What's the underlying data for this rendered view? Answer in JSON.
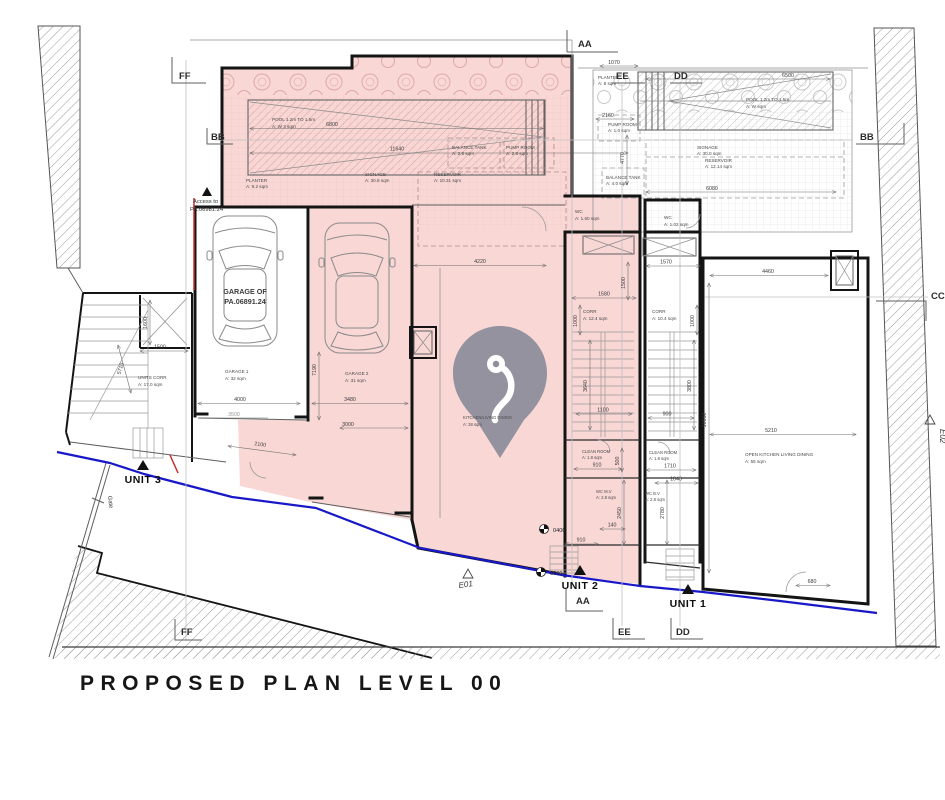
{
  "title": "PROPOSED PLAN LEVEL 00",
  "colors": {
    "highlight_pink": "#f8d7d5",
    "boundary_blue": "#1818c8",
    "boundary_red": "#cc2b2b",
    "pin_gray": "#8e8e9b"
  },
  "section_markers": {
    "aa": "AA",
    "bb": "BB",
    "cc": "CC",
    "dd": "DD",
    "ee": "EE",
    "ff": "FF"
  },
  "unit_markers": {
    "unit1": "UNIT 1",
    "unit2": "UNIT 2",
    "unit3": "UNIT 3"
  },
  "elevation_markers": {
    "e01": "E01",
    "e02": "E02"
  },
  "levels": {
    "l0400": "0400",
    "l0000": "0000"
  },
  "site": {
    "gate": "Gate",
    "access1": "Access to",
    "access2": "PA.06981.24",
    "garage_of1": "GARAGE OF",
    "garage_of2": "PA.06891.24"
  },
  "rooms": {
    "pool_l1": "POOL 1.2m TO 1.5m",
    "pool_l2": "A: W 3 sqm",
    "planter_l1": "PLANTER",
    "planter_l2": "A: 9.2 sqm",
    "signage_l1": "SIGNAGE",
    "signage_l2": "A: 30.8 sqm",
    "reservoir_l1": "RESERVOIR",
    "reservoir_l2": "A: 10.31 sqm",
    "balance_l1": "BALANCE TANK",
    "balance_l2": "A: 2.8 sqm",
    "pump_l1": "PUMP ROOM",
    "pump_l2": "A: 2.8 sqm",
    "planter_r1": "PLANTER",
    "planter_r2": "A: 8 sqm",
    "pool_r1": "POOL 1.2m TO 1.5m",
    "pool_r2": "A: W sqm",
    "pump_r1": "PUMP ROOM",
    "pump_r2": "A: 1.0 sqm",
    "signage_r1": "SIGNAGE",
    "signage_r2": "A: 30.0 sqm",
    "reservoir_r1": "RESERVOIR",
    "reservoir_r2": "A: 12.14 sqm",
    "balance_r1": "BALANCE TANK",
    "balance_r2": "A: 4.0 sqm",
    "garage1_1": "GARAGE 1",
    "garage1_2": "A: 32 sqm",
    "garage2_1": "GARAGE 2",
    "garage2_2": "A: 31 sqm",
    "units_corr1": "UNITS CORR",
    "units_corr2": "A: 17.0 sqm",
    "wc_pink1": "WC",
    "wc_pink2": "A: 1.60 sqm",
    "wc_white1": "WC",
    "wc_white2": "A: 1.02 sqm",
    "corr_pink1": "CORR",
    "corr_pink2": "A: 12.4 sqm",
    "corr_white1": "CORR",
    "corr_white2": "A: 10.4 sqm",
    "clean1": "CLEAN ROOM",
    "clean2": "A: 1.8 sqm",
    "wc_mv1": "WC M.V",
    "wc_mv2": "A: 2.8 sqm",
    "wc_bv1": "WC B.V",
    "wc_bv2": "A: 2.8 sqm",
    "okld1": "OPEN KITCHEN LIVING DINING",
    "okld2": "A: 55 sqm",
    "kld1": "KITCHEN/LIVING DINING",
    "kld2": "A: 38 sqm"
  },
  "dims": {
    "d6800": "6800",
    "d11640": "11640",
    "d6500": "6500",
    "d1070": "1070",
    "d2160": "2160",
    "d4770": "4770",
    "d6080": "6080",
    "d4220": "4220",
    "d4460": "4460",
    "d5210": "5210",
    "d10660": "10660",
    "d4000": "4000",
    "d3500": "3500",
    "d3480": "3480",
    "d3000": "3000",
    "d7190": "7190",
    "d1580": "1580",
    "d1500": "1500",
    "d1570": "1570",
    "d1000": "1000",
    "d1100": "1100",
    "d900": "900",
    "d3640": "3640",
    "d3800": "3800",
    "d910": "910",
    "d500": "500",
    "d1710": "1710",
    "d1040": "1040",
    "d2450": "2450",
    "d140": "140",
    "d2780": "2780",
    "d680": "680",
    "d2100": "2100",
    "d5710": "5710",
    "d1600": "1600"
  }
}
